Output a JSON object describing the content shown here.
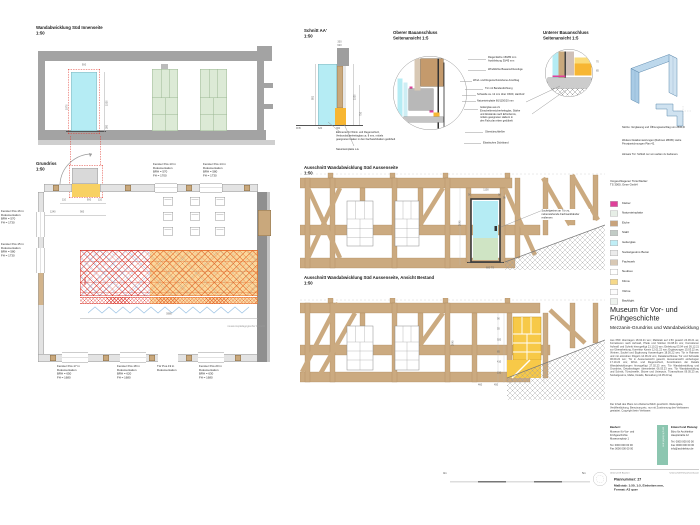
{
  "colors": {
    "glass_cyan": "#b5ecf4",
    "klima_orange": "#f7b632",
    "highlight_yellow": "#f7c948",
    "timber": "#cbaa80",
    "hatch_red": "#e0392f",
    "kleber_magenta": "#e0409a",
    "steel_blue": "#5d89ad",
    "wall_gray": "#a3a3a3",
    "bestand_gray": "#8f8f8f",
    "door_green": "#dcead6"
  },
  "views": {
    "wand_innen": {
      "title": "Wandabwicklung Süd Innenseite",
      "scale": "1:50",
      "dims": {
        "door_w": "900",
        "door_h": "1530",
        "sockel": "380",
        "left_h": "1970"
      }
    },
    "grundriss": {
      "title": "Grundriss",
      "scale": "1:50",
      "dims": {
        "jamb_l": "110",
        "door_w": "900",
        "jamb_r": "110",
        "off": "1240",
        "opening": "900",
        "vitrine_len": "5980"
      },
      "vitrine_label": "Vitrine",
      "paed_note": "museumspädagogischer Bereich",
      "ann_top_1": "Fenster Pos.13 in\nDokumentation\nBRH = 570\nFH = 1700",
      "ann_top_2": "Fenster Pos.14 in\nDokumentation\nBRH = 580\nFH = 1730",
      "ann_left_1": "Fenster Pos.16 in\nDokumentation\nBRH = 570\nFH = 1730",
      "ann_left_2": "Fenster Pos.15 in\nDokumentation\nBRH = 580\nFH = 1730",
      "ann_bot_1": "Fenster Pos.17 in\nDokumentation\nBRH = 650\nFH = 1680",
      "ann_bot_2": "Fenster Pos.18 in\nDokumentation\nBRH = 620\nFH = 1680",
      "ann_bot_3": "Tür Pos.19 in\nDokumentation",
      "ann_bot_4": "Fenster Pos.20 in\nDokumentation\nBRH = 630\nFH = 1680"
    },
    "schnitt": {
      "title": "Schnitt AA'",
      "scale": "1:50",
      "ffb": "FFB",
      "dims": {
        "t1": "330",
        "t2": "620",
        "r1": "1530",
        "r2": "750",
        "l1": "881",
        "b1": "620",
        "b2": "360"
      },
      "note_glass": "Elemente für Wind- und Regenschutz,\nVerbundsicherheitsglas ca. 8 mm, mittels\ngeeigneten Haken in den Fachwerkbalken gedübelt",
      "note_stone": "Natursteinplatte o.ä."
    },
    "detail_oben": {
      "title": "Oberer Bauanschluss",
      "subtitle": "Seitenansicht 1:5",
      "callouts": [
        "Riegel Eiche 150/80 mm\nAusklinkung 30/45 mm",
        "Winddichte Bauanschlussfuge",
        "Wind- und Regenschutzebene Anschlag",
        "Tür mit Bandendichtung",
        "Schwelle ca. 12 mm über OKFF, Hartholz",
        "Natursteinplatte 60/1150/20 mm",
        "Isolierglas aus 2x\nEinscheibensicherheitsglas, Stärke\nund Abstände nach Erfordernis,\nmittels geeigneten Haltern in\nden Falz plan eben gedübelt",
        "Obentürschließer",
        "Elastisches Dichtband"
      ]
    },
    "detail_unten": {
      "title": "Unterer Bauanschluss",
      "subtitle": "Seitenansicht 1:5",
      "dims": {
        "r1": "70",
        "r2": "85"
      }
    },
    "aussen_neu": {
      "title": "Ausschnitt Wandabwicklung Süd Aussenseite",
      "scale": "1:50",
      "callout": "Sockelgesims an Tür zu,\nnebenstehende Fachwerkbänder\nentfernen",
      "dims": {
        "s1": "90",
        "w": "1100",
        "s2": "90",
        "h": "2045",
        "r": "90",
        "b": "600 TS"
      }
    },
    "aussen_bestand": {
      "title": "Ausschnitt Wandabwicklung Süd Aussenseite, Ansicht Bestand",
      "scale": "1:50",
      "dims": {
        "h": "2045",
        "c1": "90",
        "c2": "55",
        "c3": "920",
        "c4": "85",
        "c5": "410",
        "c6": "150",
        "b1": "460",
        "b2": "450"
      }
    }
  },
  "notes": {
    "n1": "Skizze: Verglasung und Öffnungsanschlag von 2506-D",
    "n2": "Weitere Detailumsetzungen (Rahmen 2BOB): siehe Prinzipzeichnungen Plan 42.",
    "n3": "Hinweis Tür: Schloß nur von außen zu bedienen."
  },
  "legend": {
    "header": "Vorgeschlagener Türschließer:\nTS 3000, Geze GmbH",
    "items": [
      {
        "label": "Kleber",
        "color": "#e0409a"
      },
      {
        "label": "Natursteinplatte",
        "color": "#e6eee6"
      },
      {
        "label": "Eiche",
        "color": "#c8a37c"
      },
      {
        "label": "Stahl",
        "color": "#c2ccc6"
      },
      {
        "label": "Isolierglas",
        "color": "#bfeef6"
      },
      {
        "label": "Sockelgesims Beton",
        "color": "#ebebeb"
      },
      {
        "label": "Fachwerk",
        "color": "#d8c8b4"
      },
      {
        "label": "Neubau",
        "color": "#ffffff"
      },
      {
        "label": "Klima",
        "color": "#f6d98a"
      },
      {
        "label": "Vitrine",
        "color": "#fcfcfc"
      },
      {
        "label": "Backlight",
        "color": "#eef3ee"
      }
    ]
  },
  "titleblock": {
    "project": "Museum für Vor- und\nFrühgeschichte",
    "subtitle": "Mezzanin-Grundriss und Wandabwicklung",
    "revisions": "Aus PDF übertragen 18.04.21 wm; Maßstab auf 1:50 gesetzt 24.06.21 as; Korrekturen nach Aufmaß, Pfeile und Stützen 04.08.21 wm; Korrekturen Aufmaß und Schnitt hinzugefügt 21.10.21 wm; Einleitung 03.04 und 05.12.21 zur Überarbeitung, Korrektur Kamin 12.01.22 wm; Ergänzungen 15.03.22 as; Vitrinen, Sockel und Ergänzung Aussenfugen 18.05.22 wm; Tür in Rahmen und mit einzelnen Flügeln 14.06.22 wm; Detailanschlüsse Tür und Schwelle 06.09.22 wm; Tür in Aussenansicht gesetzt, Aussenansicht einbezogen 17.10.22 wm; Wind- und Regenschutz, Koordination der Details Wandabwicklungen hinzugefügt 27.02.23 wm; Tür Wandabwicklung und Grundriss, Detailvorlagen überarbeitet 06.03.23 wm; Tür Wandabwicklung und Schnitt, Türschwelle, Skizze und Unterputz, Türanschluss 09.05.23 as; Sockelgesims, Maße, Details, Bemaßung 10.05.23 aq",
    "copyright": "Der Inhalt des Plans ist urheberrechtlich geschützt. Weitergabe, Veröffentlichung, Benutzung etc. nur mit Zustimmung des Verfassers gestattet. Copyright beim Verfasser.",
    "client_label": "Bauherr:",
    "client_lines": "Museum für Vor- und\nFrühgeschichte\nMuseumsplatz 1\n\nTel. 0000 000 00 00\nFax 0000 000 00 00",
    "architect_label": "Entwurf und Planung:",
    "architect_lines": "Büro für Architektur\nHauptstraße 12\n\nTel. 0000 000 00 00\nFax 0000 000 00 00\ninfo@architektur.de",
    "logo_text": "architekten",
    "sig_left": "Unterschrift Bauherr",
    "sig_right": "Unterschrift Entwurfsverfasser",
    "plan_number": "Plannummer: 27",
    "format_note": "Maßstab: 1:50, 1:5, Einheiten mm,\nFormat: A3 quer"
  },
  "scalebar": {
    "left": "0m",
    "right": "5m"
  }
}
